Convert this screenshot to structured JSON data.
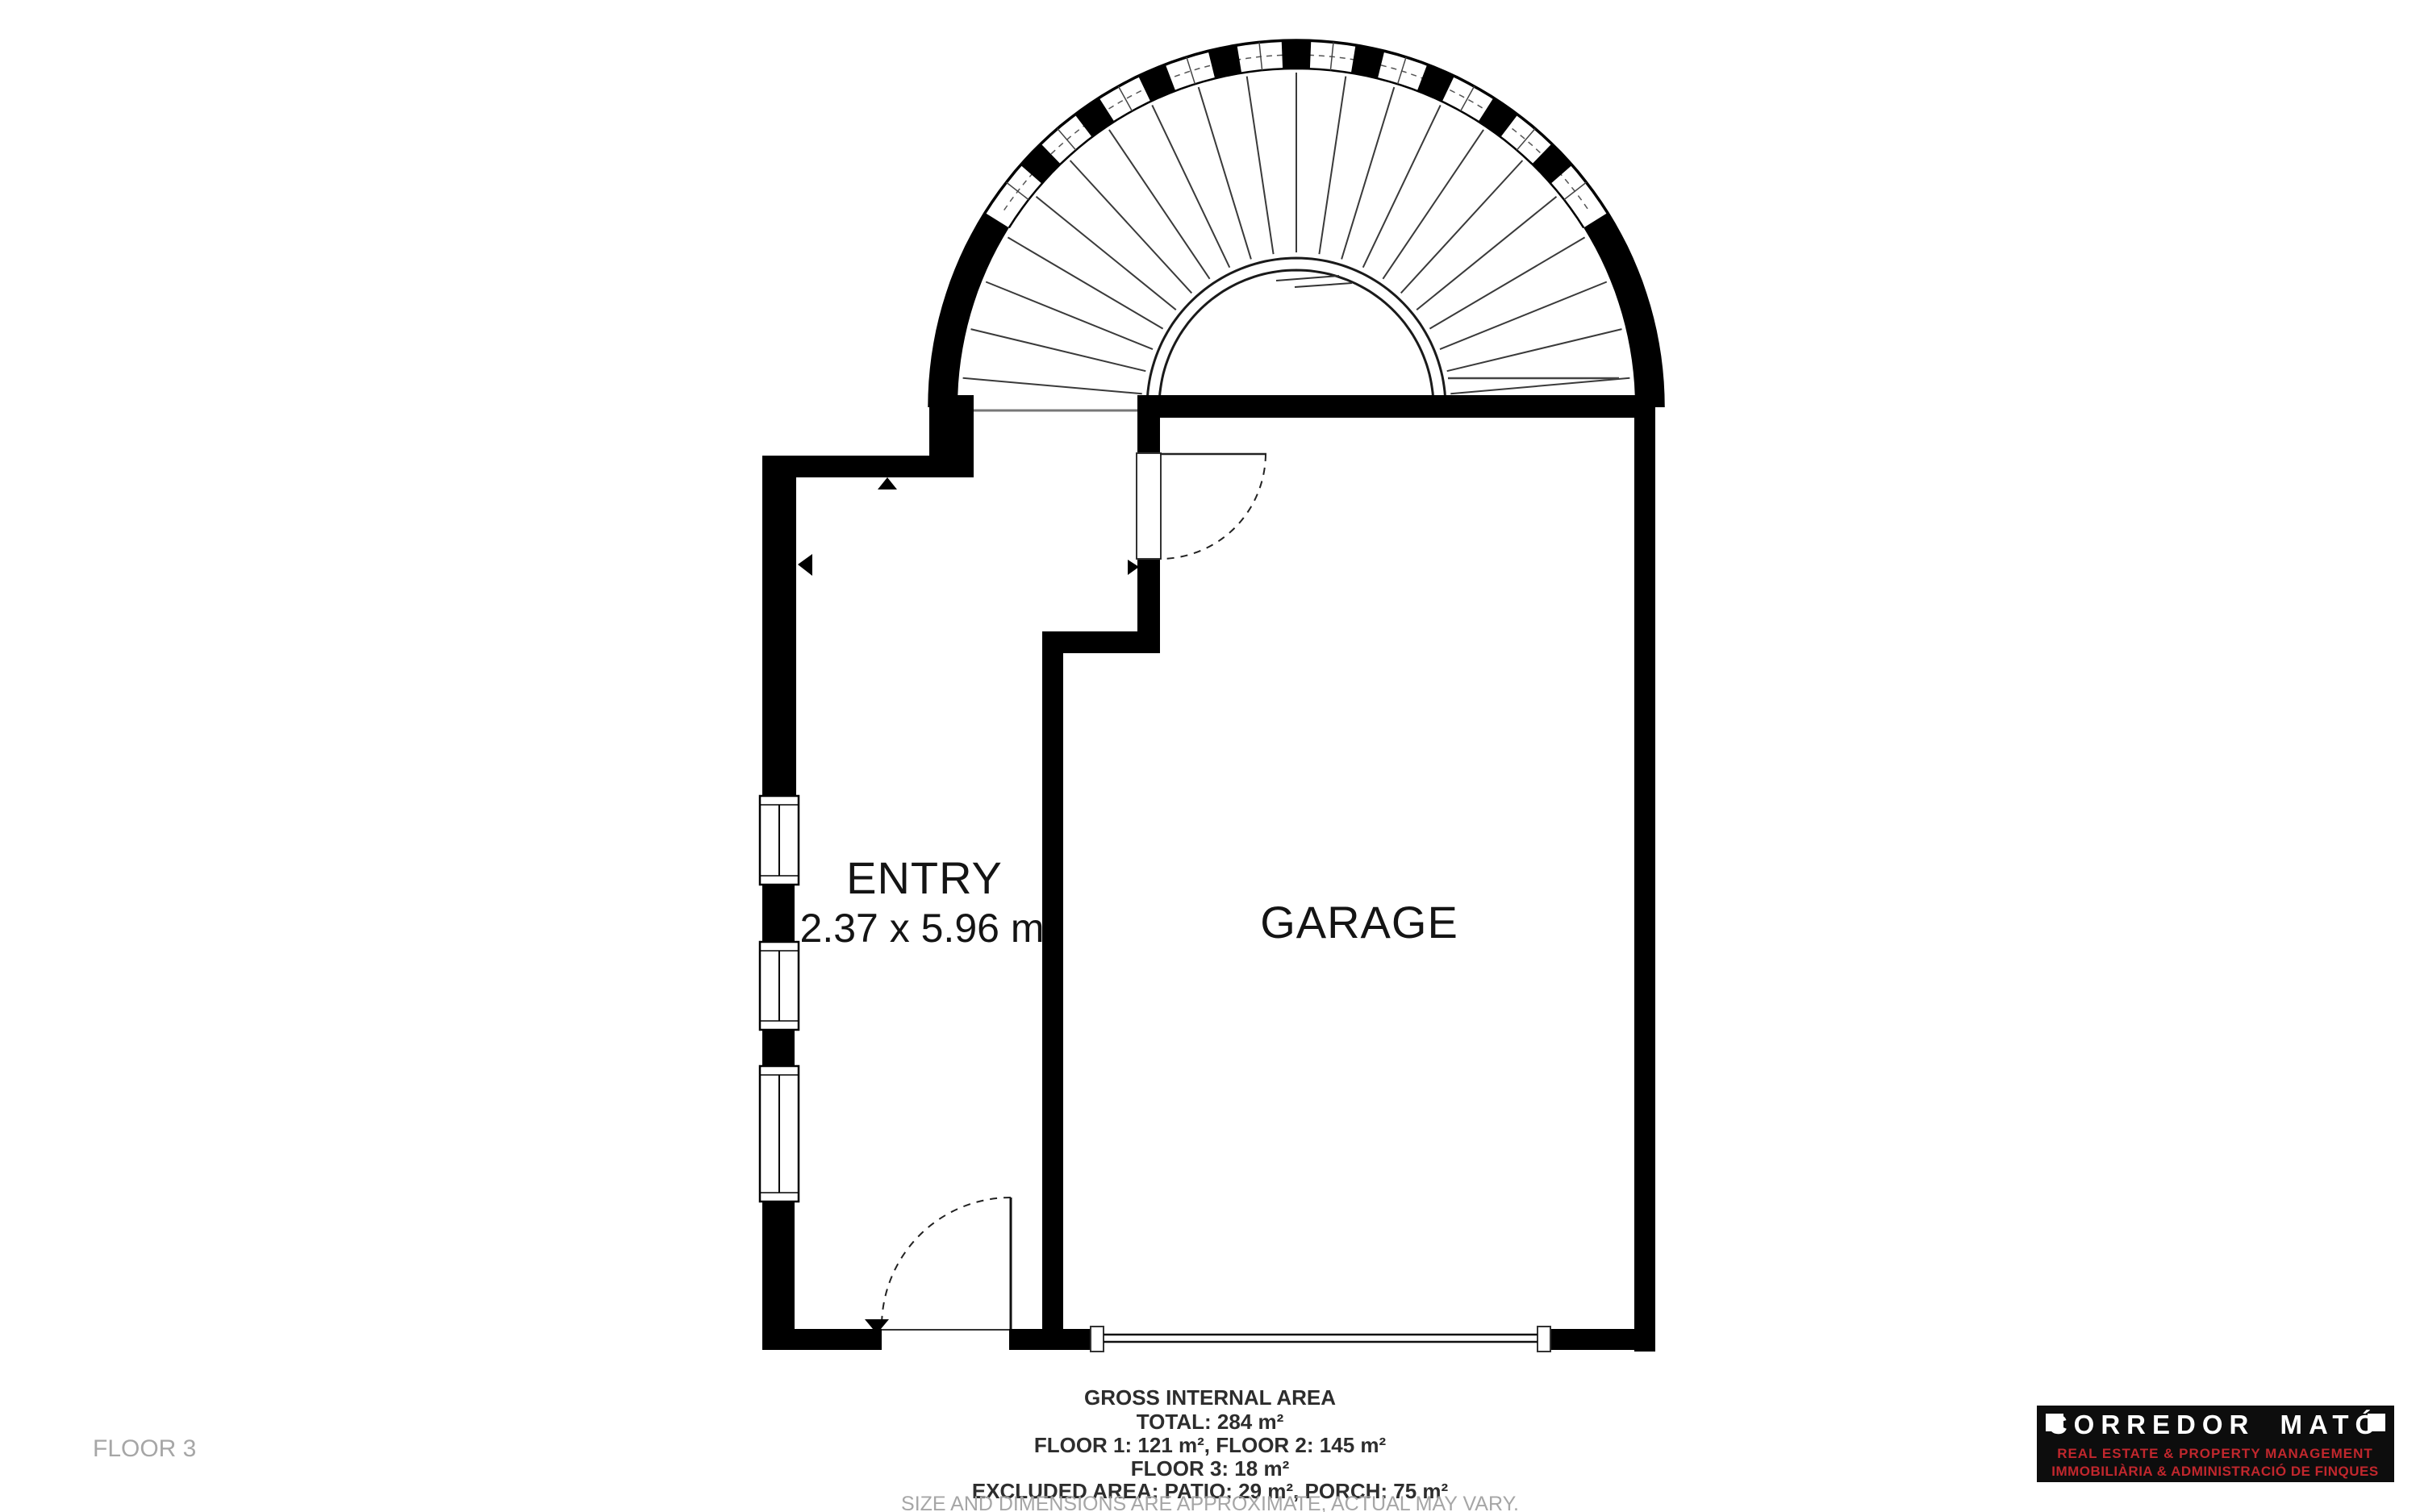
{
  "page": {
    "background": "#ffffff"
  },
  "floorplan": {
    "rooms": [
      {
        "name": "ENTRY",
        "dimensions": "2.37 x 5.96 m"
      },
      {
        "name": "GARAGE"
      }
    ],
    "floor_label": "FLOOR 3",
    "footer": {
      "title": "GROSS INTERNAL AREA",
      "total": "TOTAL: 284 m²",
      "floors_1_2": "FLOOR 1: 121 m², FLOOR 2: 145 m²",
      "floor_3": "FLOOR 3: 18 m²",
      "excluded": "EXCLUDED AREA: PATIO: 29 m², PORCH: 75 m²",
      "disclaimer": "SIZE AND DIMENSIONS ARE APPROXIMATE, ACTUAL MAY VARY."
    },
    "logo": {
      "title": "CORREDOR MATÓ",
      "subtitle_en": "REAL ESTATE & PROPERTY MANAGEMENT",
      "subtitle_ca": "IMMOBILIÀRIA & ADMINISTRACIÓ DE FINQUES"
    },
    "colors": {
      "wall": "#000000",
      "thin_line": "#3a3a3a",
      "porch_base_line": "#777777",
      "muted_text": "#a6a6a6",
      "logo_bg": "#0d0d0d",
      "logo_accent": "#c1272d",
      "logo_text": "#ffffff"
    }
  }
}
